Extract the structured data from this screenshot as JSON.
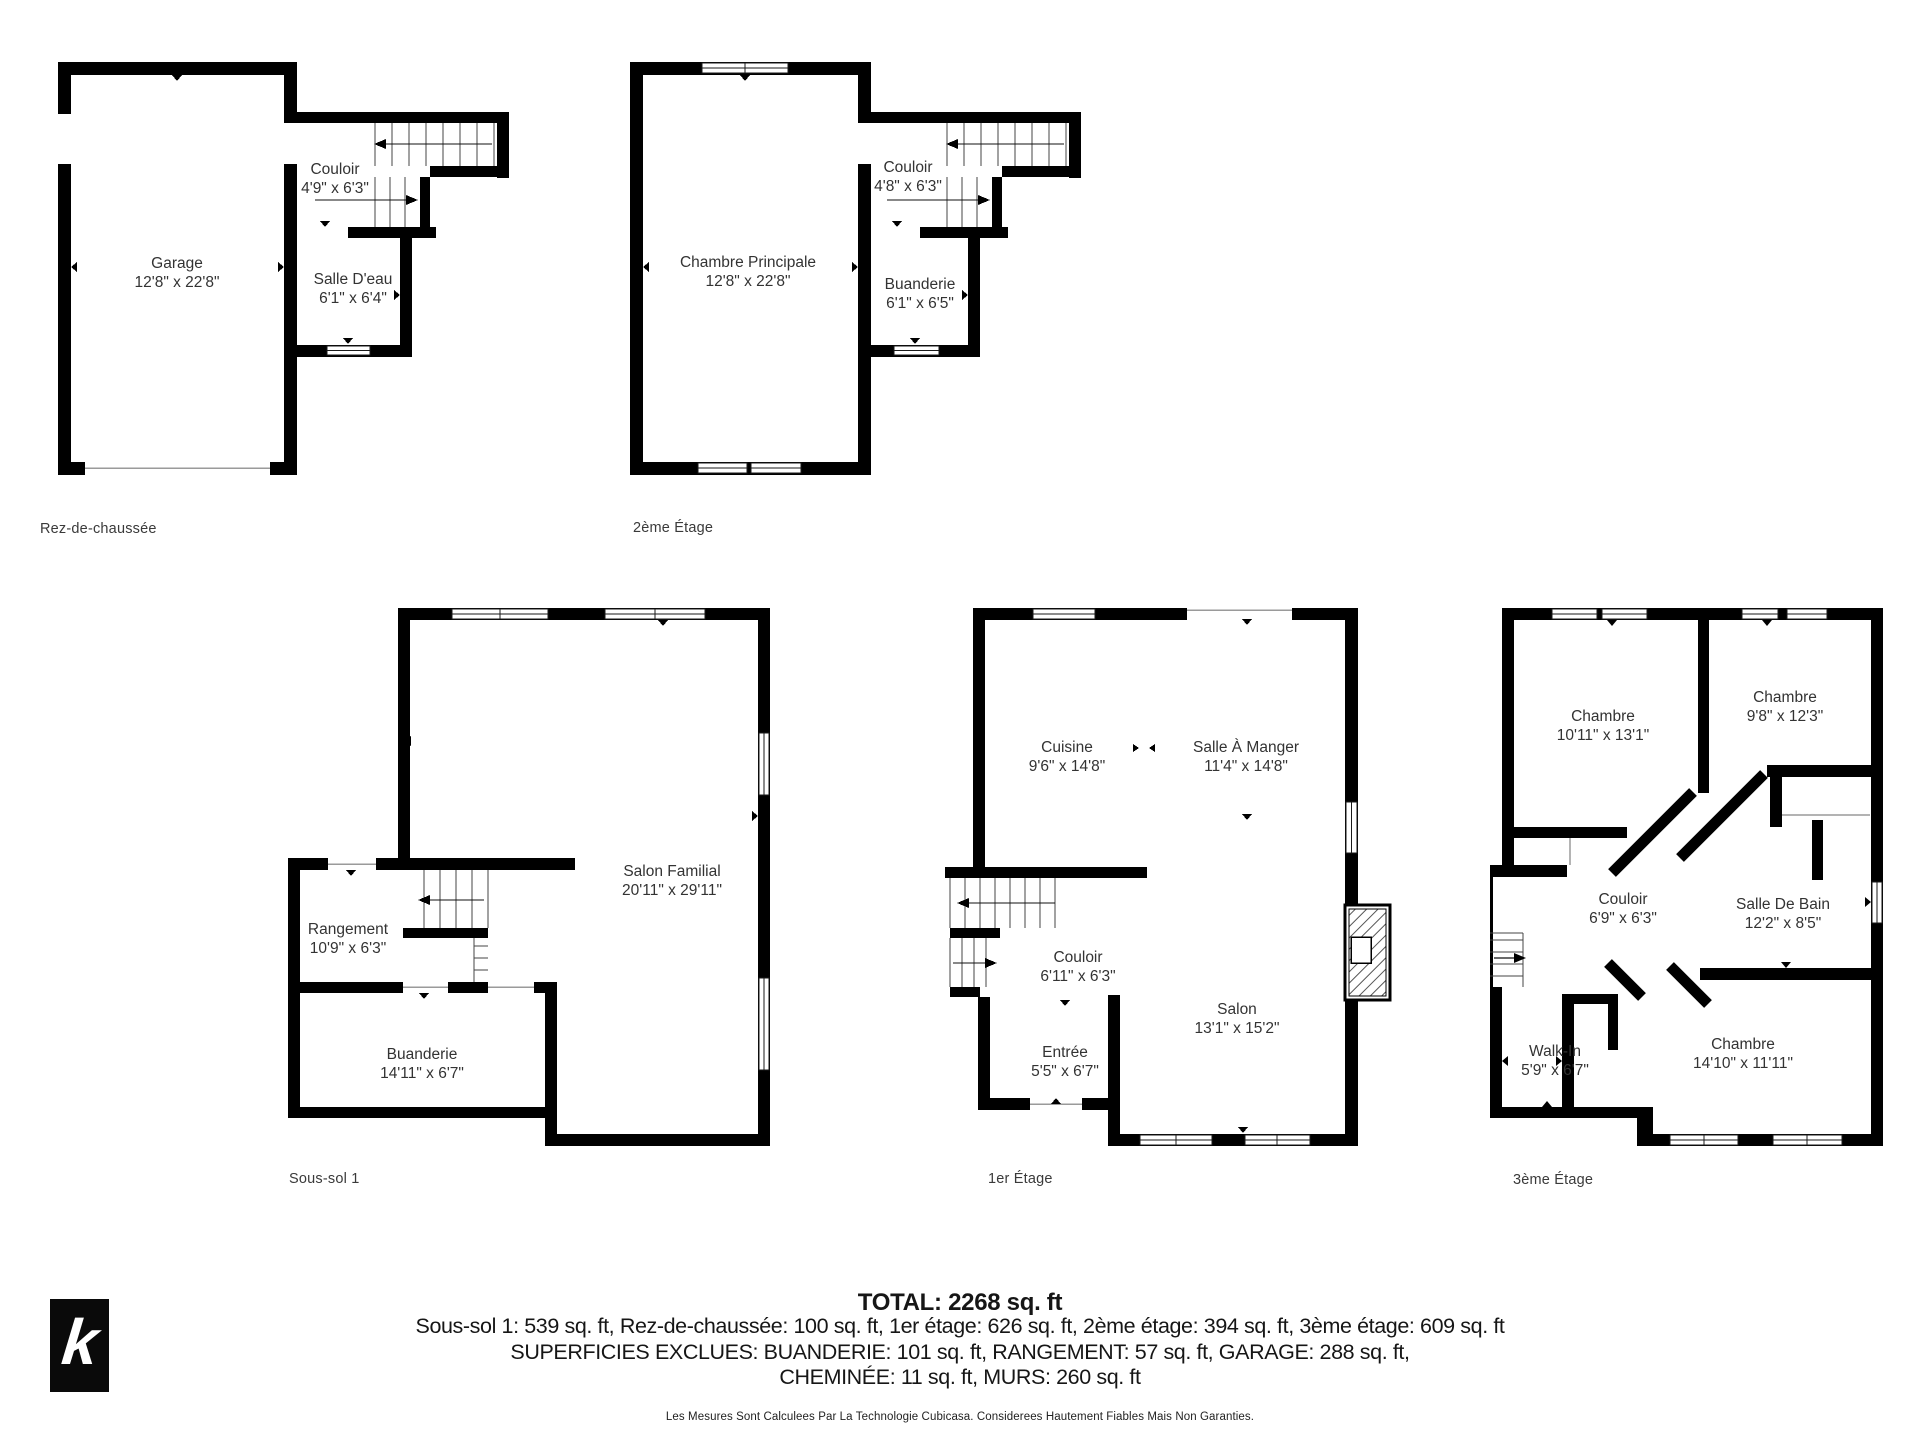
{
  "branding": {
    "logo_letter": "k"
  },
  "floors": [
    {
      "label": "Rez-de-chaussée",
      "rooms": [
        {
          "name": "Garage",
          "dims": "12'8\" x 22'8\""
        },
        {
          "name": "Couloir",
          "dims": "4'9\" x 6'3\""
        },
        {
          "name": "Salle D'eau",
          "dims": "6'1\" x 6'4\""
        }
      ]
    },
    {
      "label": "2ème Étage",
      "rooms": [
        {
          "name": "Chambre Principale",
          "dims": "12'8\" x 22'8\""
        },
        {
          "name": "Couloir",
          "dims": "4'8\" x 6'3\""
        },
        {
          "name": "Buanderie",
          "dims": "6'1\" x 6'5\""
        }
      ]
    },
    {
      "label": "Sous-sol 1",
      "rooms": [
        {
          "name": "Salon Familial",
          "dims": "20'11\" x 29'11\""
        },
        {
          "name": "Rangement",
          "dims": "10'9\" x 6'3\""
        },
        {
          "name": "Buanderie",
          "dims": "14'11\" x 6'7\""
        }
      ]
    },
    {
      "label": "1er Étage",
      "rooms": [
        {
          "name": "Cuisine",
          "dims": "9'6\" x 14'8\""
        },
        {
          "name": "Salle À Manger",
          "dims": "11'4\" x 14'8\""
        },
        {
          "name": "Couloir",
          "dims": "6'11\" x 6'3\""
        },
        {
          "name": "Salon",
          "dims": "13'1\" x 15'2\""
        },
        {
          "name": "Entrée",
          "dims": "5'5\" x 6'7\""
        }
      ]
    },
    {
      "label": "3ème Étage",
      "rooms": [
        {
          "name": "Chambre",
          "dims": "10'11\" x 13'1\""
        },
        {
          "name": "Chambre",
          "dims": "9'8\" x 12'3\""
        },
        {
          "name": "Couloir",
          "dims": "6'9\" x 6'3\""
        },
        {
          "name": "Salle De Bain",
          "dims": "12'2\" x 8'5\""
        },
        {
          "name": "Walk-In",
          "dims": "5'9\" x 6'7\""
        },
        {
          "name": "Chambre",
          "dims": "14'10\" x 11'11\""
        }
      ]
    }
  ],
  "summary": {
    "total": "TOTAL: 2268 sq. ft",
    "floor_areas": "Sous-sol 1: 539 sq. ft, Rez-de-chaussée: 100 sq. ft, 1er étage: 626 sq. ft, 2ème étage: 394 sq. ft, 3ème étage: 609 sq. ft",
    "excluded_1": "SUPERFICIES EXCLUES: BUANDERIE: 101 sq. ft, RANGEMENT: 57 sq. ft, GARAGE: 288 sq. ft,",
    "excluded_2": "CHEMINÉE: 11 sq. ft, MURS: 260 sq. ft",
    "disclaimer": "Les Mesures Sont Calculees Par La Technologie Cubicasa. Considerees Hautement Fiables Mais Non Garanties."
  }
}
